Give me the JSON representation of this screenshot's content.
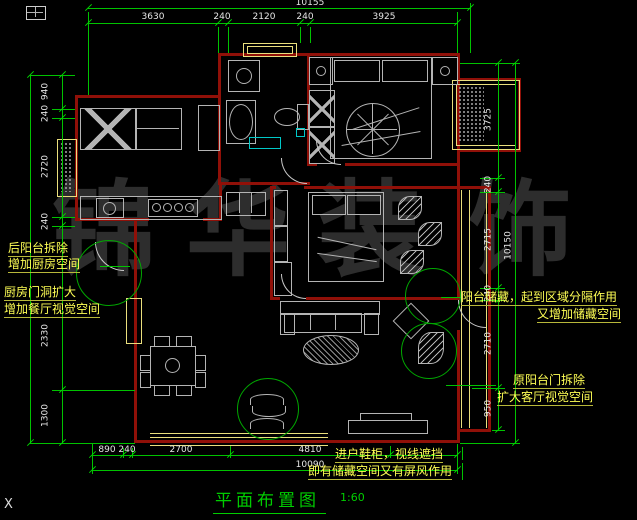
{
  "drawing": {
    "title": "平面布置图",
    "scale": "1:60"
  },
  "watermark": {
    "text": "锦华装饰",
    "chars": [
      "锦",
      "华",
      "装",
      "饰"
    ]
  },
  "dimensions": {
    "top": {
      "overall": "10155",
      "segments": [
        "3630",
        "240",
        "2120",
        "240",
        "3925"
      ]
    },
    "bottom": {
      "overall": "10090",
      "segments": [
        "890",
        "240",
        "2700",
        "4810"
      ]
    },
    "left": {
      "segments": [
        "940",
        "240",
        "2720",
        "240",
        "2330",
        "1300"
      ]
    },
    "right": {
      "overall": "10150",
      "segments": [
        "3725",
        "240",
        "2715",
        "240",
        "2710",
        "950"
      ]
    }
  },
  "annotations": {
    "kitchen_balcony": {
      "line1": "后阳台拆除",
      "line2": "增加厨房空间"
    },
    "kitchen_door": {
      "line1": "厨房门洞扩大",
      "line2": "增加餐厅视觉空间"
    },
    "balcony_storage": {
      "line1": "阳台储藏，起到区域分隔作用",
      "line2": "又增加储藏空间"
    },
    "balcony_door": {
      "line1": "原阳台门拆除",
      "line2": "扩大客厅视觉空间"
    },
    "entry_cabinet": {
      "line1": "进户鞋柜，视线遮挡",
      "line2": "即有储藏空间又有屏风作用"
    }
  },
  "corner_mark": "X",
  "colors": {
    "wall": "#901008",
    "dim_line": "#00c300",
    "annotation": "#ffff55",
    "title": "#00cd00",
    "window": "#eadf7d",
    "callout": "#00a800"
  }
}
